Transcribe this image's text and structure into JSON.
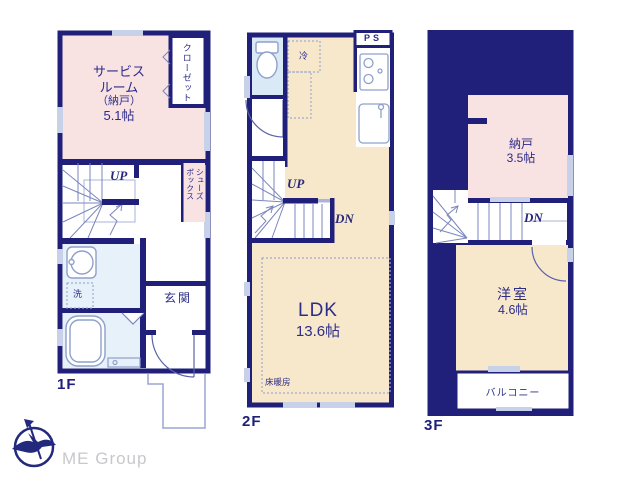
{
  "colors": {
    "wall_navy": "#20207a",
    "room_pink": "#f8e2e2",
    "room_cream": "#f7e8cb",
    "room_blue": "#d9e9f6",
    "wet_blue": "#e7f1fa",
    "window_light": "#c7d2ea",
    "line_thin": "#7b86bd",
    "text_navy": "#2c2c8a",
    "logo_gray": "#c8c8cc"
  },
  "f1": {
    "label": "1F",
    "service_room": [
      "サービス",
      "ルーム",
      "（納戸）",
      "5.1帖"
    ],
    "closet": "クローゼット",
    "shoe_box": [
      "シューズ",
      "ボックス"
    ],
    "up": "UP",
    "laundry": "洗",
    "entrance": "玄関"
  },
  "f2": {
    "label": "2F",
    "ps": "PS",
    "fridge": "冷",
    "up": "UP",
    "dn": "DN",
    "ldk": [
      "LDK",
      "13.6帖"
    ],
    "floor_heating": "床暖房"
  },
  "f3": {
    "label": "3F",
    "storage": [
      "納戸",
      "3.5帖"
    ],
    "dn": "DN",
    "western_room": [
      "洋室",
      "4.6帖"
    ],
    "balcony": "バルコニー"
  },
  "logo": {
    "company": "ME Group"
  }
}
